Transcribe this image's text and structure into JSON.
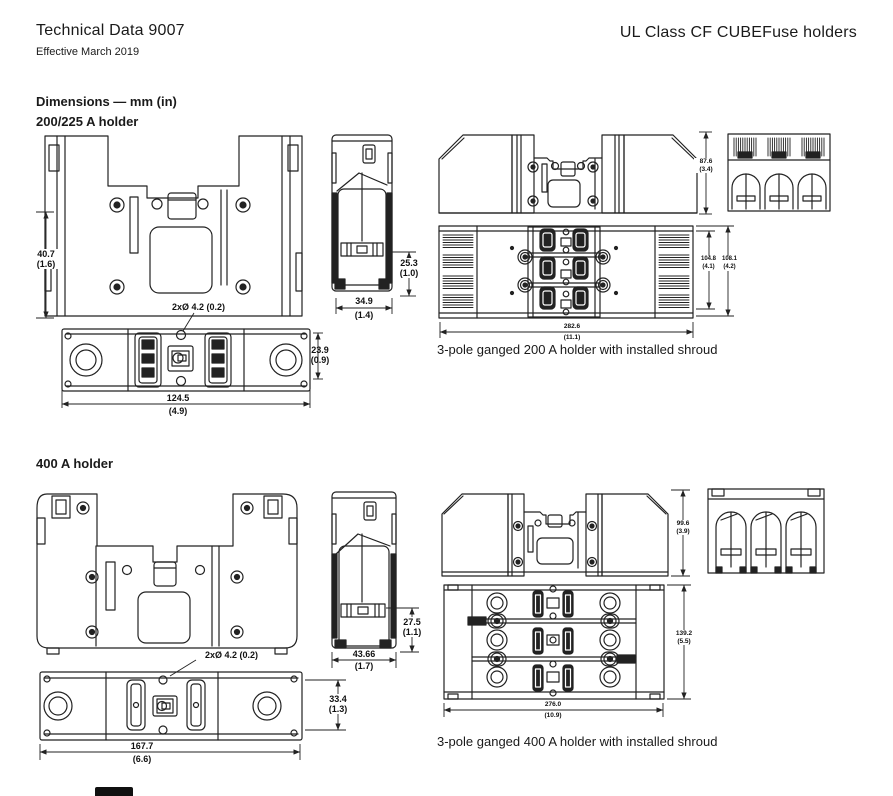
{
  "header": {
    "title": "Technical Data 9007",
    "effective": "Effective March 2019",
    "product": "UL Class CF CUBEFuse holders"
  },
  "sections": {
    "dimensions_heading": "Dimensions — mm (in)",
    "holder200": {
      "heading": "200/225 A holder",
      "hole_callout": "2xØ 4.2 (0.2)",
      "caption": "3-pole ganged 200 A holder with installed shroud",
      "dims": {
        "front_height": {
          "mm": "40.7",
          "in": "(1.6)"
        },
        "bottom_depth": {
          "mm": "23.9",
          "in": "(0.9)"
        },
        "bottom_width": {
          "mm": "124.5",
          "in": "(4.9)"
        },
        "side_slot_height": {
          "mm": "25.3",
          "in": "(1.0)"
        },
        "side_width": {
          "mm": "34.9",
          "in": "(1.4)"
        },
        "ganged_height": {
          "mm": "87.6",
          "in": "(3.4)"
        },
        "ganged_depth_inner": {
          "mm": "104.8",
          "in": "(4.1)"
        },
        "ganged_depth_outer": {
          "mm": "108.1",
          "in": "(4.2)"
        },
        "ganged_width": {
          "mm": "282.6",
          "in": "(11.1)"
        }
      }
    },
    "holder400": {
      "heading": "400 A holder",
      "hole_callout": "2xØ 4.2 (0.2)",
      "caption": "3-pole ganged 400 A holder with installed shroud",
      "dims": {
        "bottom_depth": {
          "mm": "33.4",
          "in": "(1.3)"
        },
        "bottom_width": {
          "mm": "167.7",
          "in": "(6.6)"
        },
        "side_slot_height": {
          "mm": "27.5",
          "in": "(1.1)"
        },
        "side_width": {
          "mm": "43.66",
          "in": "(1.7)"
        },
        "ganged_height": {
          "mm": "99.6",
          "in": "(3.9)"
        },
        "ganged_depth": {
          "mm": "139.2",
          "in": "(5.5)"
        },
        "ganged_width": {
          "mm": "276.0",
          "in": "(10.9)"
        }
      }
    }
  }
}
